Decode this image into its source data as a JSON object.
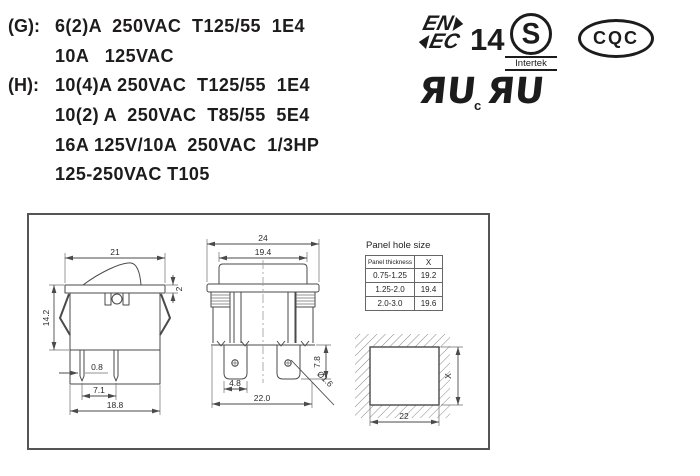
{
  "ratings": {
    "lines": [
      {
        "label": "(G):",
        "text": "6(2)A  250VAC  T125/55  1E4"
      },
      {
        "label": "",
        "text": "10A   125VAC"
      },
      {
        "label": "(H):",
        "text": "10(4)A 250VAC  T125/55  1E4"
      },
      {
        "label": "",
        "text": "10(2) A  250VAC  T85/55  5E4"
      },
      {
        "label": "",
        "text": "16A 125V/10A  250VAC  1/3HP"
      },
      {
        "label": "",
        "text": "125-250VAC T105"
      }
    ]
  },
  "certs": {
    "enec_line1": "EN",
    "enec_line2": "EC",
    "enec_number": "14",
    "intertek_letter": "S",
    "intertek_label": "Intertek",
    "cqc": "CQC",
    "ul_mark": "ЯU",
    "ul_c": "c"
  },
  "drawing": {
    "side_view": {
      "width_top": "21",
      "flange_thickness": "2",
      "height": "14.2",
      "pin_thickness": "0.8",
      "pin_spacing": "7.1",
      "body_width": "18.8"
    },
    "front_view": {
      "flange_width": "24",
      "rocker_width": "19.4",
      "terminal_length": "7.8",
      "terminal_width": "4.8",
      "body_width": "22.0",
      "hole_diameter": "Ø1.6"
    },
    "panel_cutout": {
      "width": "22",
      "height_ref": "X"
    },
    "panel_table": {
      "title": "Panel hole size",
      "headers": [
        "Panel thickness",
        "X"
      ],
      "rows": [
        [
          "0.75-1.25",
          "19.2"
        ],
        [
          "1.25-2.0",
          "19.4"
        ],
        [
          "2.0-3.0",
          "19.6"
        ]
      ]
    }
  }
}
